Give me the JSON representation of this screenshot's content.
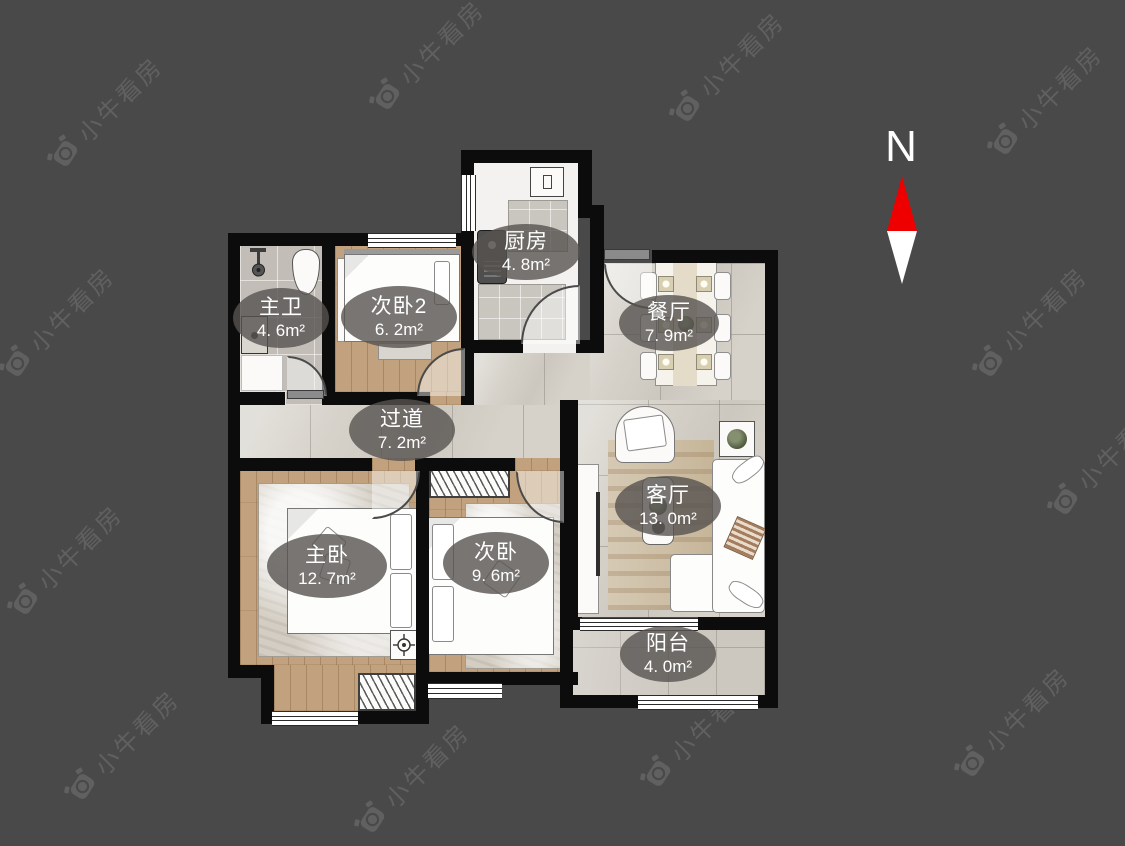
{
  "colors": {
    "background": "#4a494a",
    "wall": "#0c0c0c",
    "marble_floor": "#d6d2ca",
    "wood_floor": "#c2a27e",
    "bath_tile": "#c2beb7",
    "balcony_tile": "#ccc7bf",
    "label_bubble": "rgba(86,83,80,0.80)",
    "label_text": "#ffffff",
    "compass_red": "#ee0000",
    "compass_white": "#ffffff",
    "watermark": "rgba(255,255,255,0.13)"
  },
  "compass": {
    "label": "N",
    "red": "#ee0000",
    "white": "#ffffff"
  },
  "watermark": {
    "text": "小牛看房",
    "positions": [
      [
        105,
        112
      ],
      [
        427,
        55
      ],
      [
        727,
        67
      ],
      [
        1045,
        100
      ],
      [
        57,
        322
      ],
      [
        1030,
        322
      ],
      [
        65,
        560
      ],
      [
        1105,
        460
      ],
      [
        122,
        745
      ],
      [
        412,
        778
      ],
      [
        698,
        732
      ],
      [
        1012,
        722
      ]
    ]
  },
  "rooms": [
    {
      "id": "master-bath",
      "name": "主卫",
      "area": "4. 6m²"
    },
    {
      "id": "bedroom2",
      "name": "次卧2",
      "area": "6. 2m²"
    },
    {
      "id": "kitchen",
      "name": "厨房",
      "area": "4. 8m²"
    },
    {
      "id": "dining",
      "name": "餐厅",
      "area": "7. 9m²"
    },
    {
      "id": "hallway",
      "name": "过道",
      "area": "7. 2m²"
    },
    {
      "id": "living",
      "name": "客厅",
      "area": "13. 0m²"
    },
    {
      "id": "master-bedroom",
      "name": "主卧",
      "area": "12. 7m²"
    },
    {
      "id": "bedroom3",
      "name": "次卧",
      "area": "9. 6m²"
    },
    {
      "id": "balcony",
      "name": "阳台",
      "area": "4. 0m²"
    }
  ],
  "icons": {
    "watermark_logo": "bull-camera-logo",
    "compass_needle": "north-needle",
    "target": "crosshair-target",
    "shower": "shower-head"
  }
}
